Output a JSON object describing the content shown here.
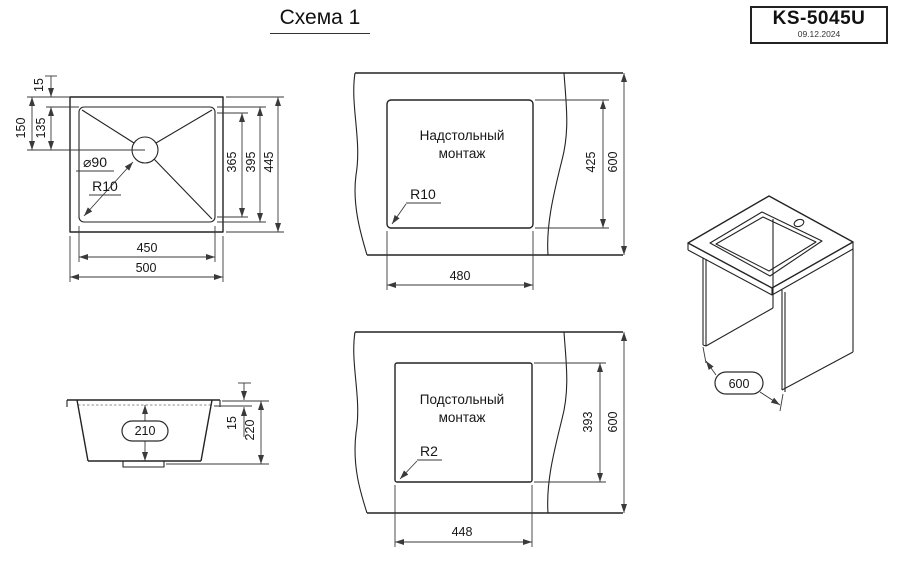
{
  "title": "Схема 1",
  "stamp": {
    "model": "KS-5045U",
    "date": "09.12.2024"
  },
  "colors": {
    "line": "#232323",
    "dim": "#3a3a3a",
    "background": "#ffffff"
  },
  "views": {
    "plan": {
      "dims": {
        "rim_offset": "15",
        "center_from_outer_top": "150",
        "center_from_inner_top": "135",
        "mid_height": "365",
        "inner_height": "395",
        "outer_height": "445",
        "inner_width": "450",
        "outer_width": "500",
        "drain_diameter": "⌀90",
        "corner_radius": "R10"
      }
    },
    "surface_mount": {
      "label_line1": "Надстольный",
      "label_line2": "монтаж",
      "dims": {
        "cutout_height": "425",
        "counter_depth": "600",
        "cutout_width": "480",
        "corner_radius": "R10"
      }
    },
    "under_mount": {
      "label_line1": "Подстольный",
      "label_line2": "монтаж",
      "dims": {
        "cutout_height": "393",
        "counter_depth": "600",
        "cutout_width": "448",
        "corner_radius": "R2"
      }
    },
    "side": {
      "dims": {
        "bowl_depth": "210",
        "rim_height": "15",
        "total_height": "220"
      }
    },
    "iso": {
      "dims": {
        "cabinet_depth": "600"
      }
    }
  }
}
